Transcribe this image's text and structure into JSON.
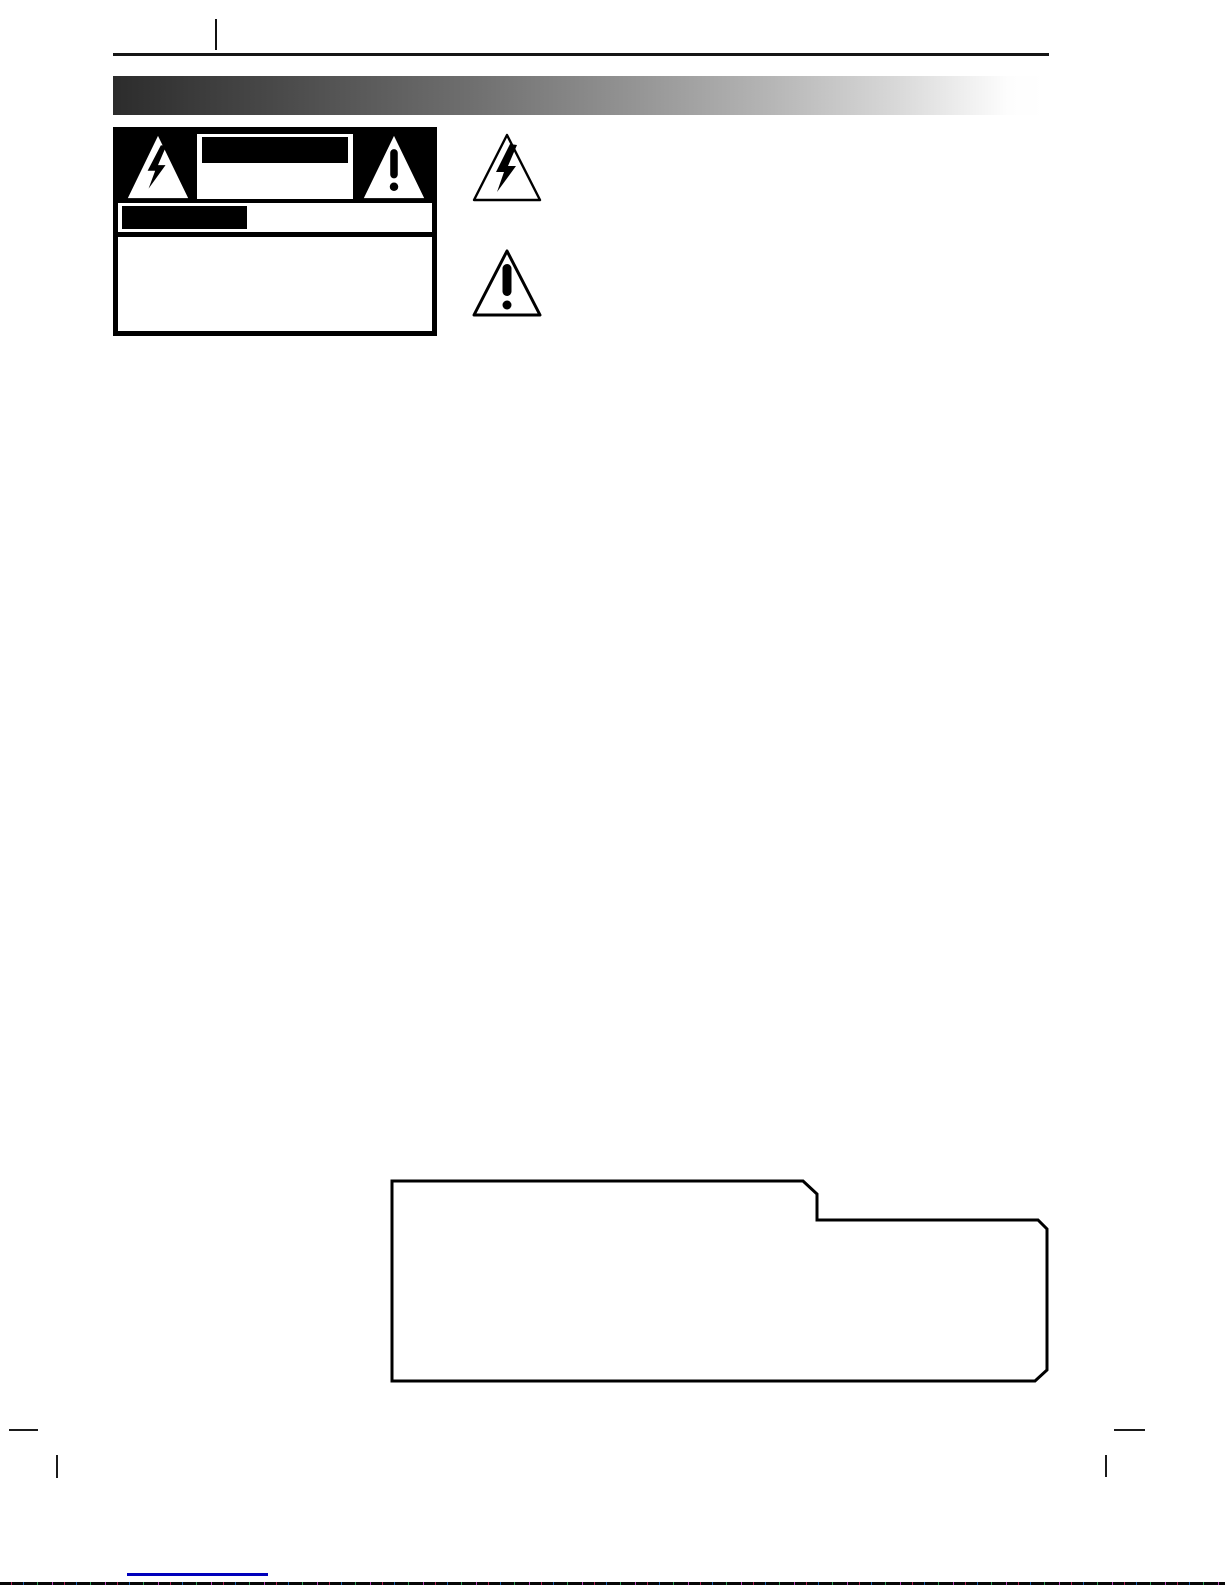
{
  "page": {
    "width_px": 1225,
    "height_px": 1585,
    "background": "#ffffff",
    "description": "scanned manual safety page, text areas blank or redacted"
  },
  "colors": {
    "ink": "#000000",
    "paper": "#ffffff",
    "title_band_start": "#2c2c2c",
    "title_band_end": "#ffffff",
    "footer_underline_blue": "#0000bb"
  },
  "title_band": {
    "text": ""
  },
  "warning_label": {
    "left_icon": "high-voltage-bolt-triangle",
    "right_icon": "exclamation-triangle",
    "center_panel_text": "",
    "redaction_bars": [
      {
        "name": "center-panel-redaction",
        "color": "#000000"
      },
      {
        "name": "band-redaction",
        "color": "#000000"
      }
    ],
    "bottom_panel_text": ""
  },
  "margin_icons": [
    {
      "name": "high-voltage-bolt-triangle"
    },
    {
      "name": "exclamation-triangle"
    }
  ],
  "note_box": {
    "shape": "outlined polygon with top-right step notch",
    "text": ""
  },
  "print_marks": {
    "top_tick": true,
    "bottom_dashes": 2,
    "bottom_ticks": 2
  },
  "scan_artifact": {
    "position": "bottom-edge",
    "base_color": "#060606"
  }
}
